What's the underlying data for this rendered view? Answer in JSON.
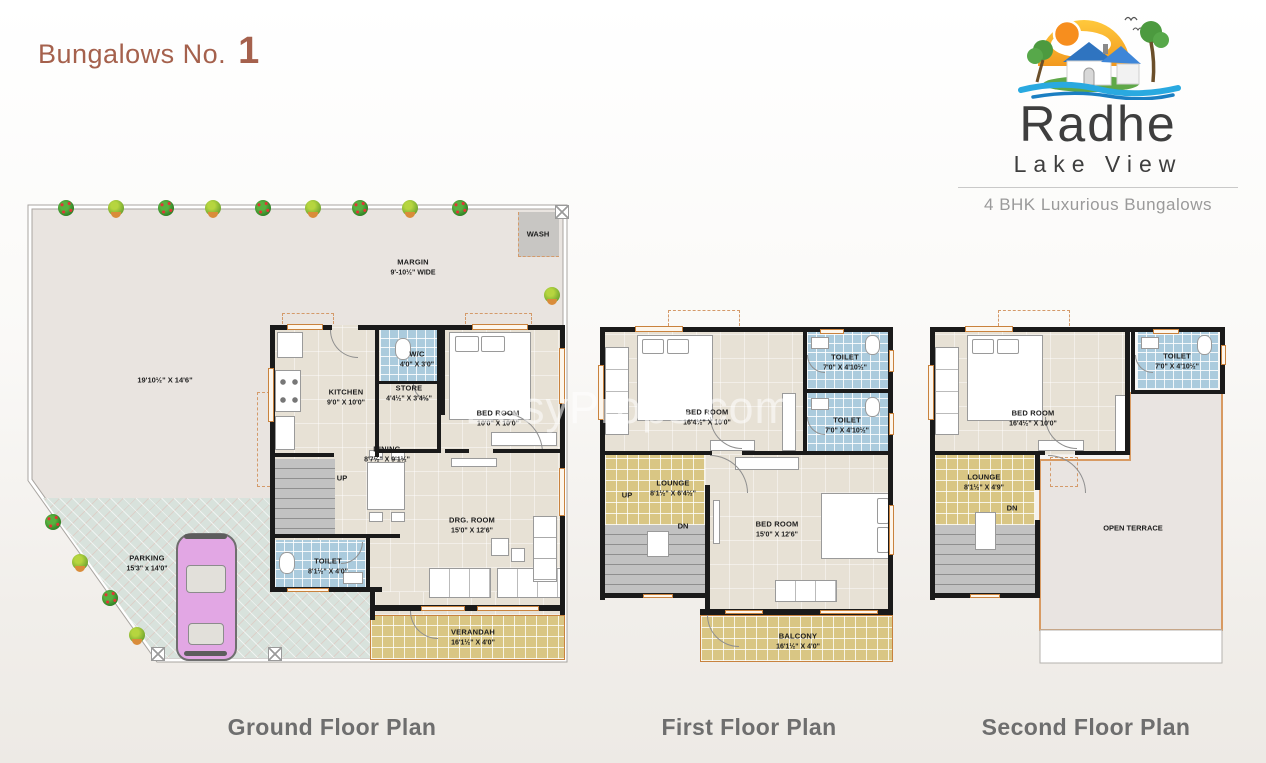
{
  "title": {
    "prefix": "Bungalows No.",
    "number": "1"
  },
  "logo": {
    "brand": "Radhe",
    "subtitle": "Lake View",
    "tagline": "4 BHK Luxurious Bungalows"
  },
  "watermark": "EasyProps.com",
  "colors": {
    "title_accent": "#A5614D",
    "caption": "#6E6E6E",
    "wall": "#1a1a1a",
    "floor_beige": "#E7E1D5",
    "tile_blue": "#ABCBDD",
    "tile_gold": "#D9C684",
    "parking": "#D8E2DC",
    "yard": "#E9E4E0",
    "window_frame": "#C9823D",
    "logo_roof_blue": "#2F74C0",
    "logo_wave_blue": "#29A9E0",
    "logo_sun_orange": "#F78E1E"
  },
  "plans": {
    "ground": {
      "caption": "Ground Floor Plan",
      "labels": {
        "plot_dim": "19'10½\" X 14'6\"",
        "margin": {
          "name": "MARGIN",
          "dims": "9'-10½\" WIDE"
        },
        "wash": "WASH",
        "kitchen": {
          "name": "KITCHEN",
          "dims": "9'0\" X 10'0\""
        },
        "wc": {
          "name": "W/C",
          "dims": "4'0\" X 3'0\""
        },
        "store": {
          "name": "STORE",
          "dims": "4'4½\" X 3'4½\""
        },
        "bedroom": {
          "name": "BED ROOM",
          "dims": "10'0\" X 10'0\""
        },
        "dining": {
          "name": "DINING",
          "dims": "8'7½\" X 9'1½\""
        },
        "up": "UP",
        "toilet": {
          "name": "TOILET",
          "dims": "8'1½\" X 4'0\""
        },
        "drawing_room": {
          "name": "DRG. ROOM",
          "dims": "15'0\" X 12'6\""
        },
        "verandah": {
          "name": "VERANDAH",
          "dims": "16'1½\" X 4'0\""
        },
        "parking": {
          "name": "PARKING",
          "dims": "15'3\" x 14'0\""
        }
      }
    },
    "first": {
      "caption": "First Floor Plan",
      "labels": {
        "bedroom1": {
          "name": "BED ROOM",
          "dims": "16'4½\" X 10'0\""
        },
        "toilet1": {
          "name": "TOILET",
          "dims": "7'0\" X 4'10½\""
        },
        "toilet2": {
          "name": "TOILET",
          "dims": "7'0\" X 4'10½\""
        },
        "lounge": {
          "name": "LOUNGE",
          "dims": "8'1½\" X 6'4½\""
        },
        "up": "UP",
        "dn": "DN",
        "bedroom2": {
          "name": "BED ROOM",
          "dims": "15'0\" X 12'6\""
        },
        "balcony": {
          "name": "BALCONY",
          "dims": "16'1½\" X 4'0\""
        }
      }
    },
    "second": {
      "caption": "Second Floor Plan",
      "labels": {
        "bedroom": {
          "name": "BED ROOM",
          "dims": "16'4½\" X 10'0\""
        },
        "toilet": {
          "name": "TOILET",
          "dims": "7'0\" X 4'10½\""
        },
        "lounge": {
          "name": "LOUNGE",
          "dims": "8'1½\" X 4'9\""
        },
        "dn": "DN",
        "open_terrace": "OPEN TERRACE"
      }
    }
  }
}
